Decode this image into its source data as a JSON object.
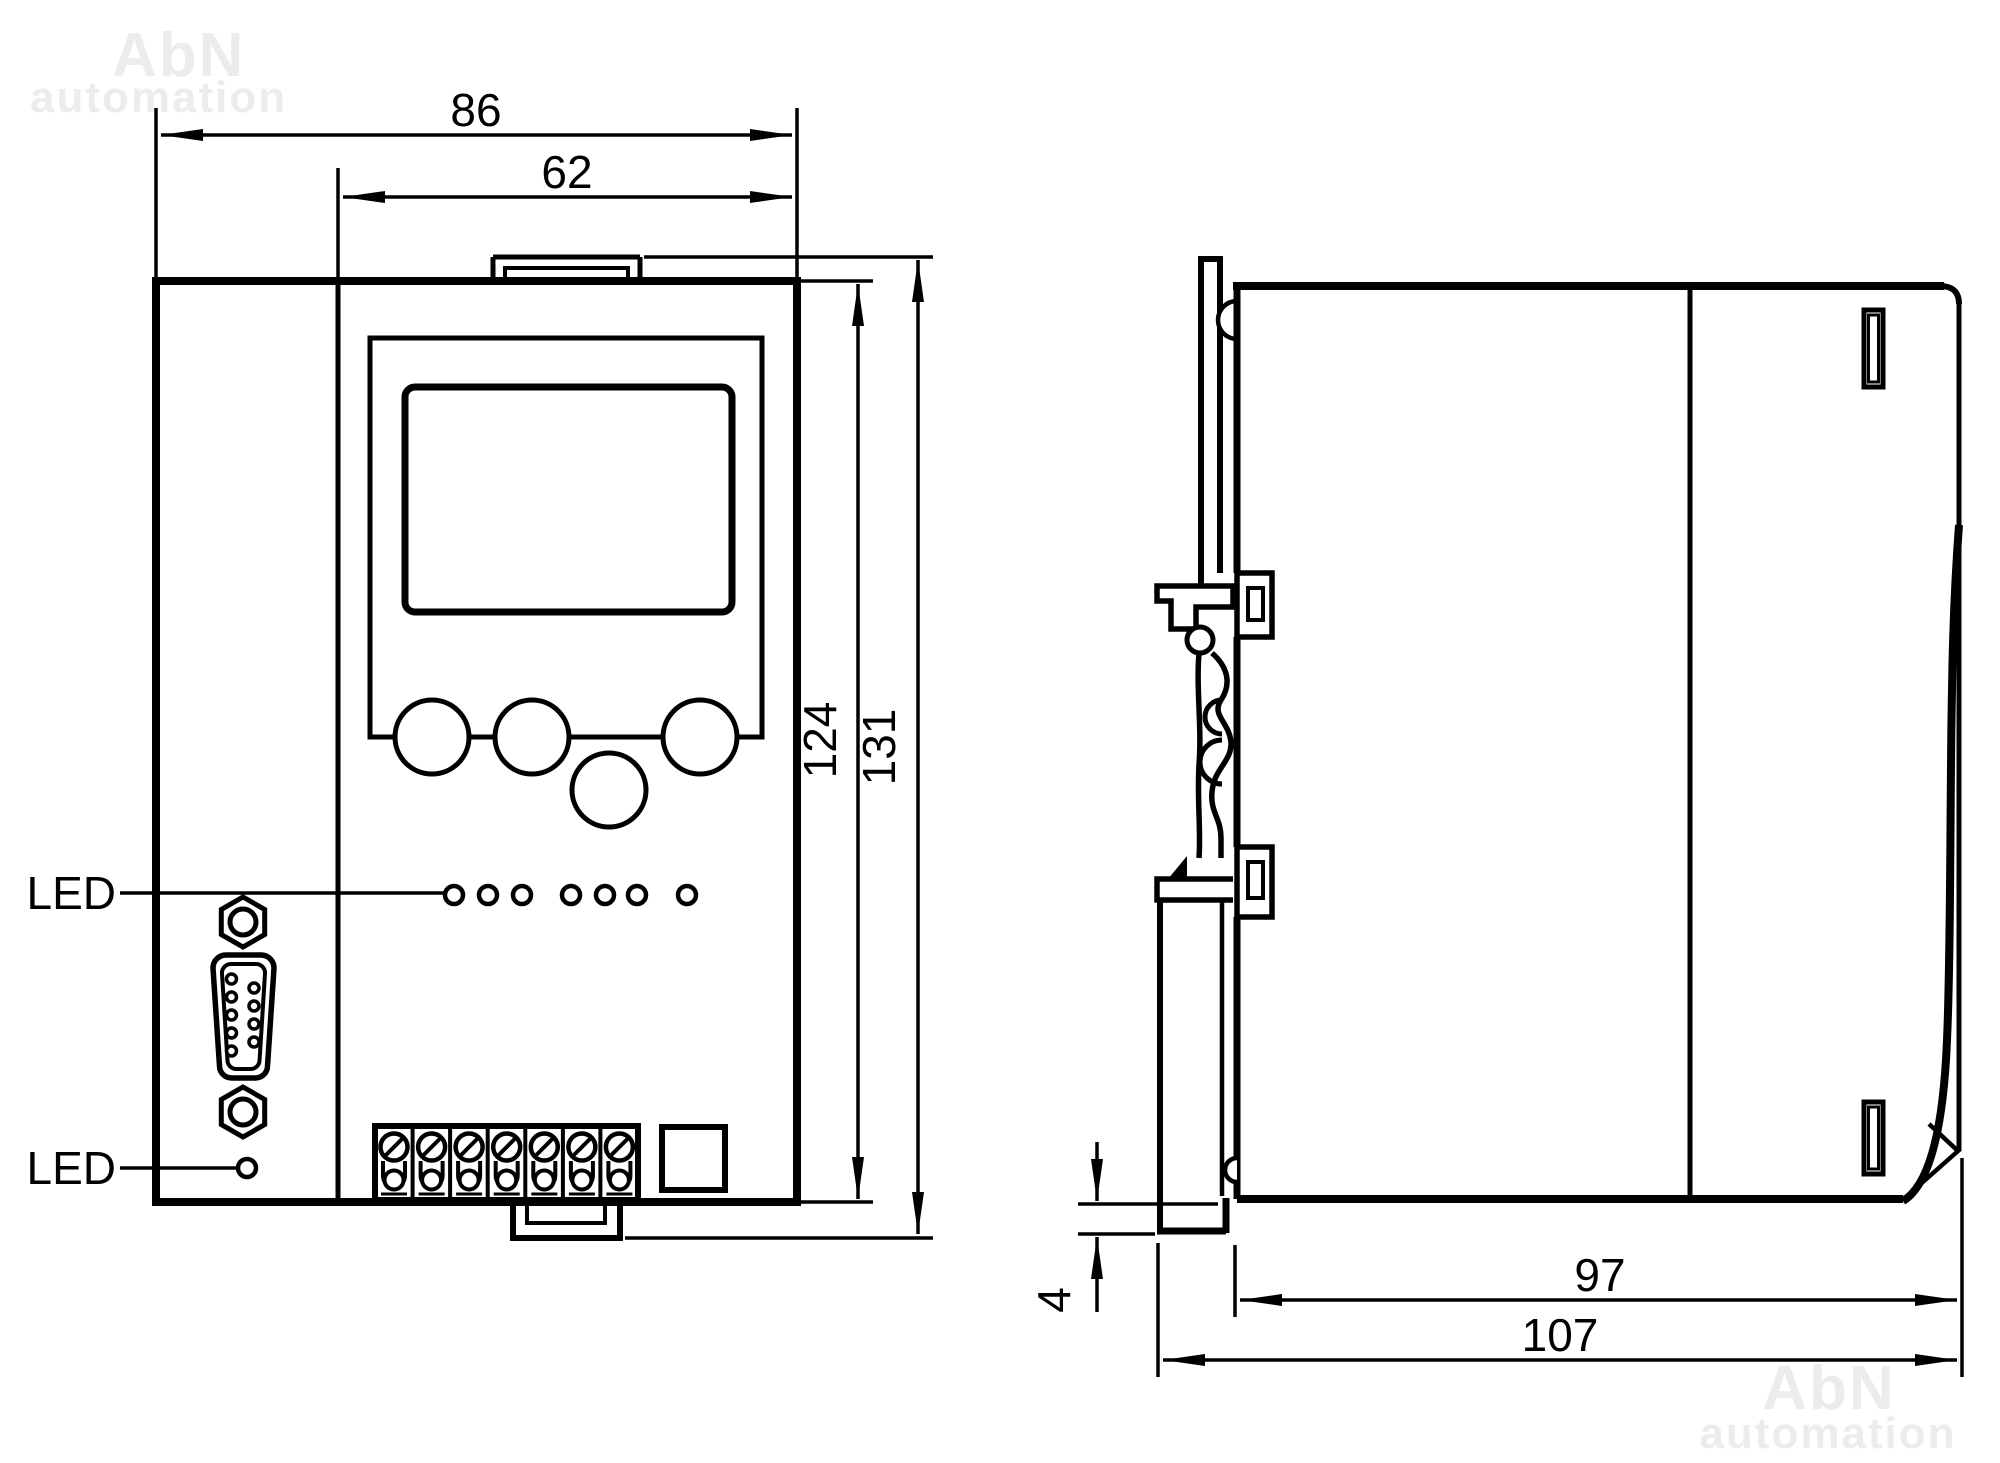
{
  "watermark": {
    "brand": "AbN",
    "word": "automation"
  },
  "labels": {
    "led_top": "LED",
    "led_bottom": "LED"
  },
  "front_view_dims": {
    "width_total": "86",
    "width_panel": "62",
    "height_body": "124",
    "height_total": "131"
  },
  "side_view_dims": {
    "depth_body": "97",
    "depth_total": "107",
    "plate_thickness": "4"
  },
  "colors": {
    "line": "#000000",
    "background": "#ffffff",
    "watermark": "#ececec"
  }
}
